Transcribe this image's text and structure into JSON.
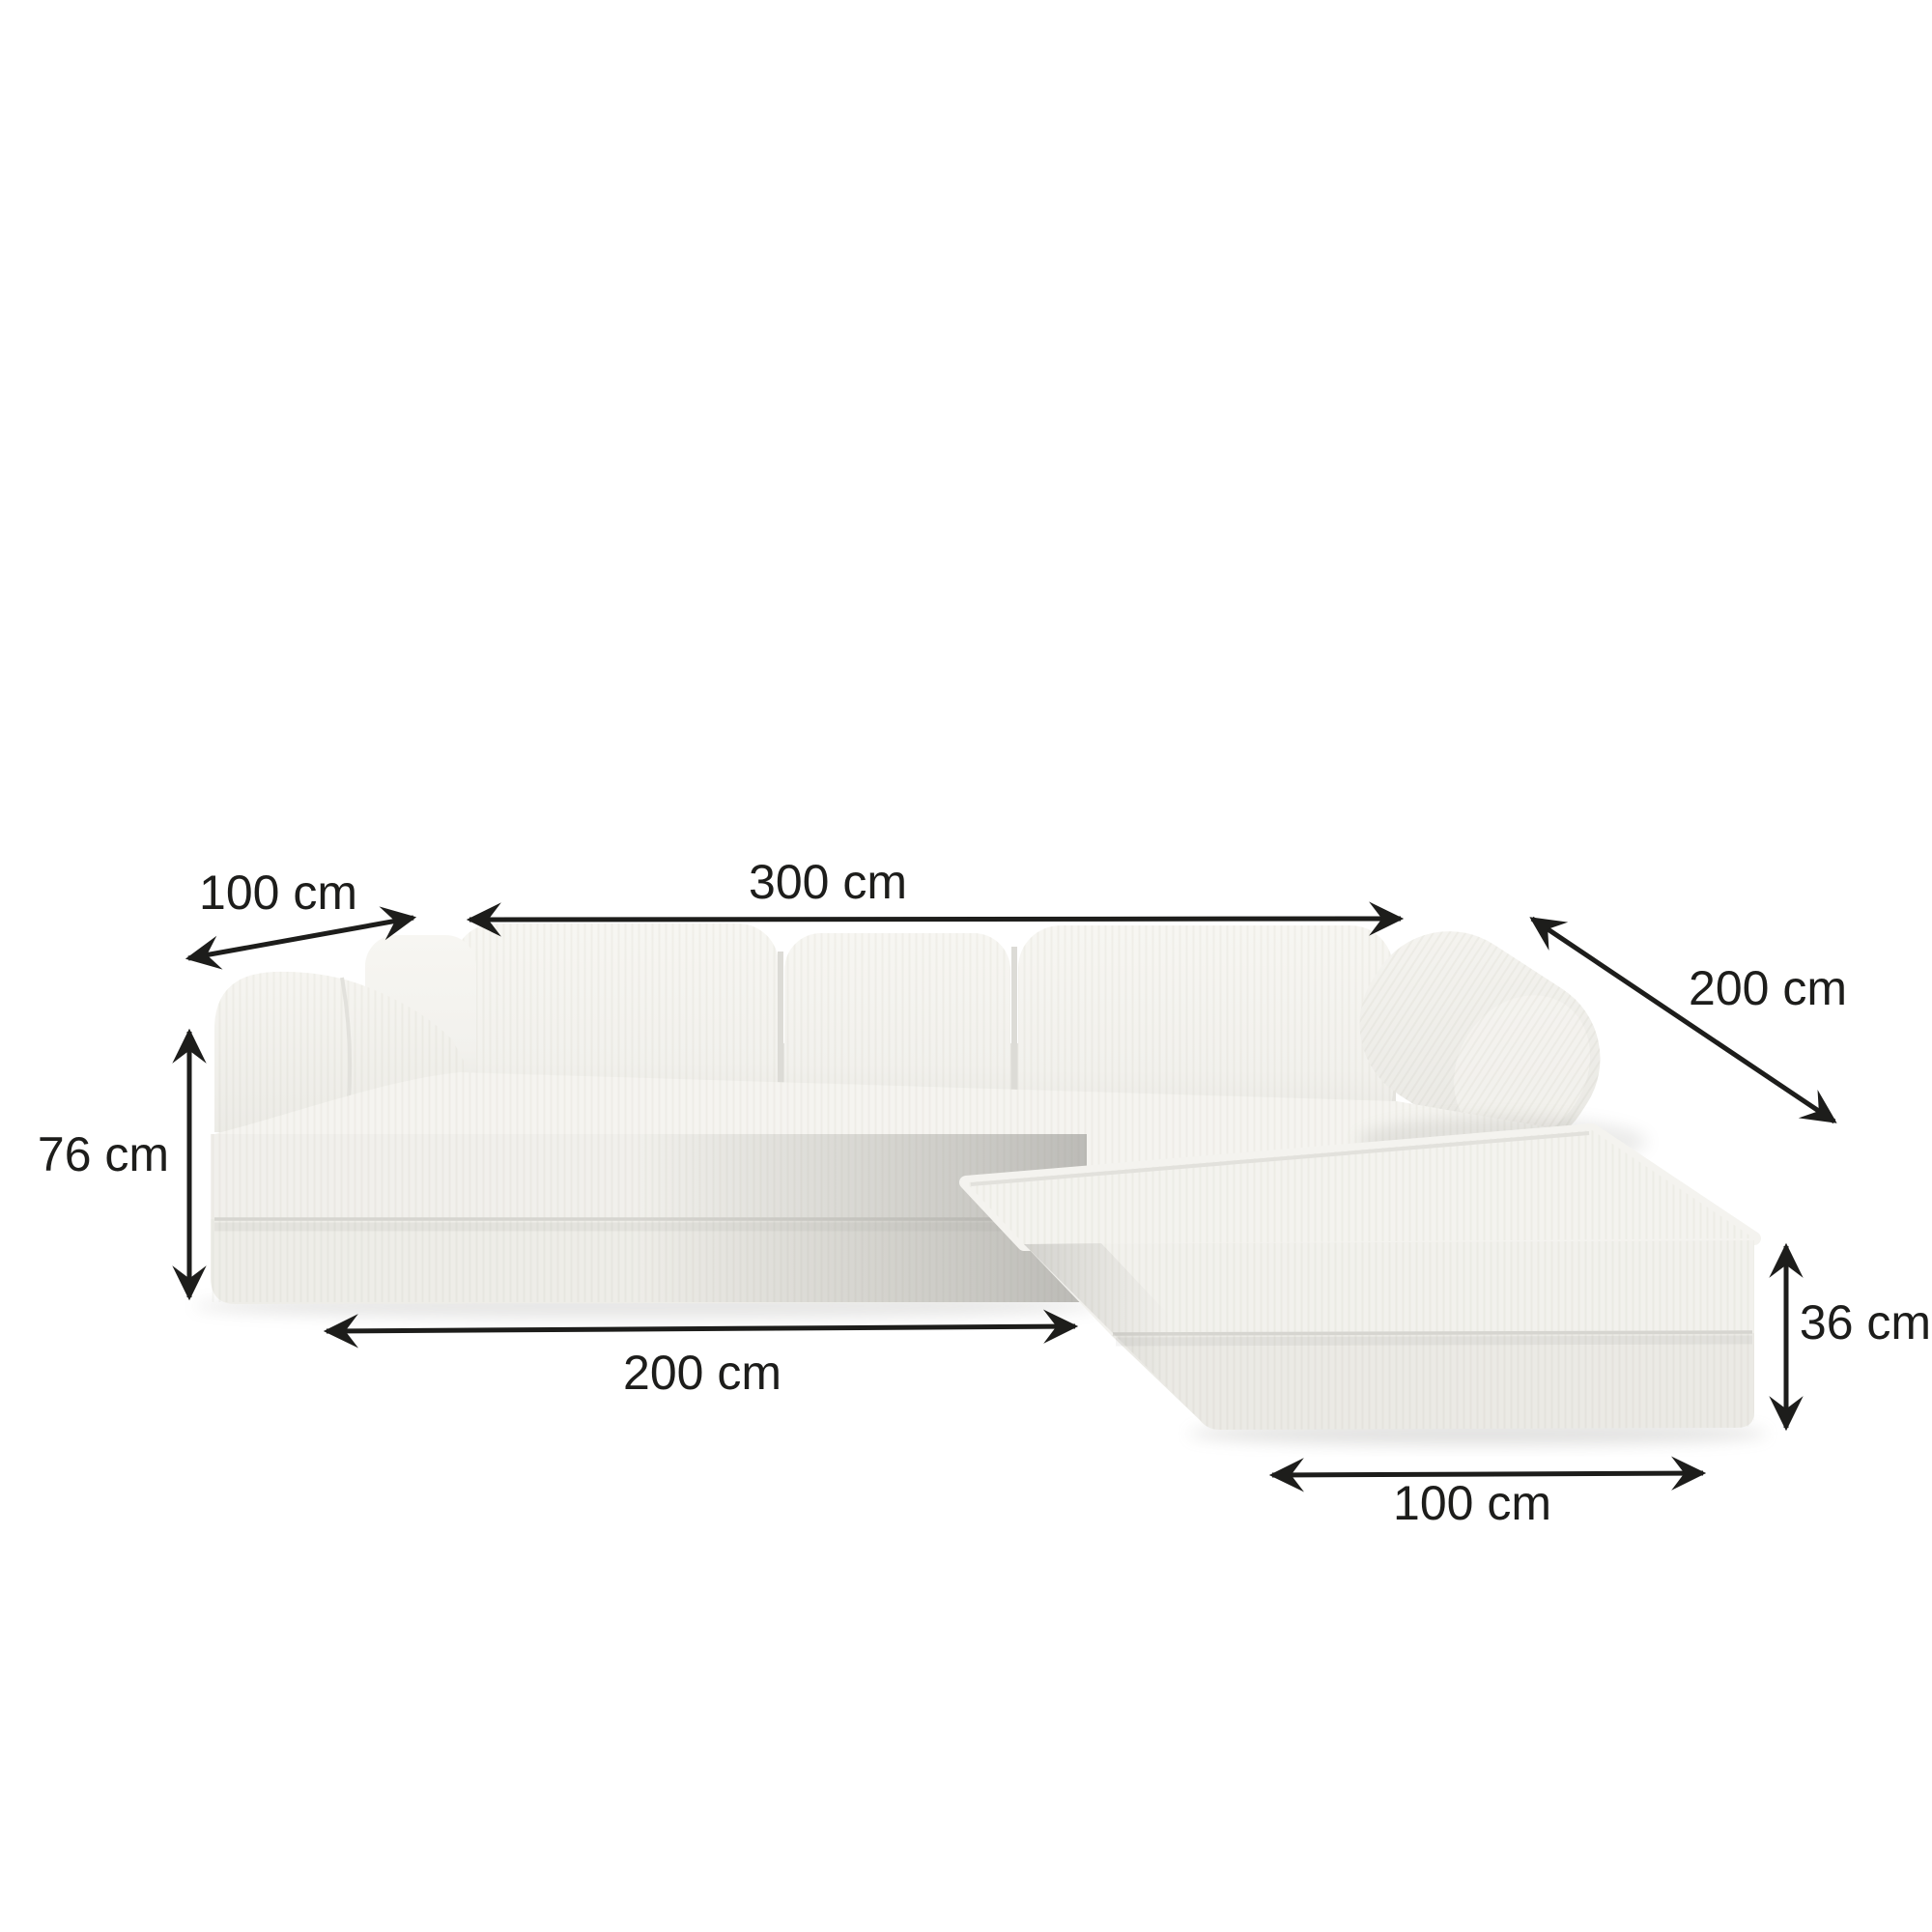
{
  "page": {
    "description": "Product dimension diagram of an L-shaped corner sofa bed with chaise ottoman",
    "background": "#ffffff"
  },
  "colors": {
    "fabric_light": "#f4f3ef",
    "fabric_mid": "#efeeea",
    "fabric_dark_shadow": "#a8a7a3",
    "seam": "#d6d5d0",
    "annotation": "#1d1d1b"
  },
  "dimensions": {
    "arm_depth": {
      "label": "100 cm"
    },
    "total_length": {
      "label": "300 cm"
    },
    "chaise_length": {
      "label": "200 cm"
    },
    "total_height": {
      "label": "76 cm"
    },
    "seat_length": {
      "label": "200 cm"
    },
    "ottoman_height": {
      "label": "36 cm"
    },
    "ottoman_width": {
      "label": "100 cm"
    }
  }
}
